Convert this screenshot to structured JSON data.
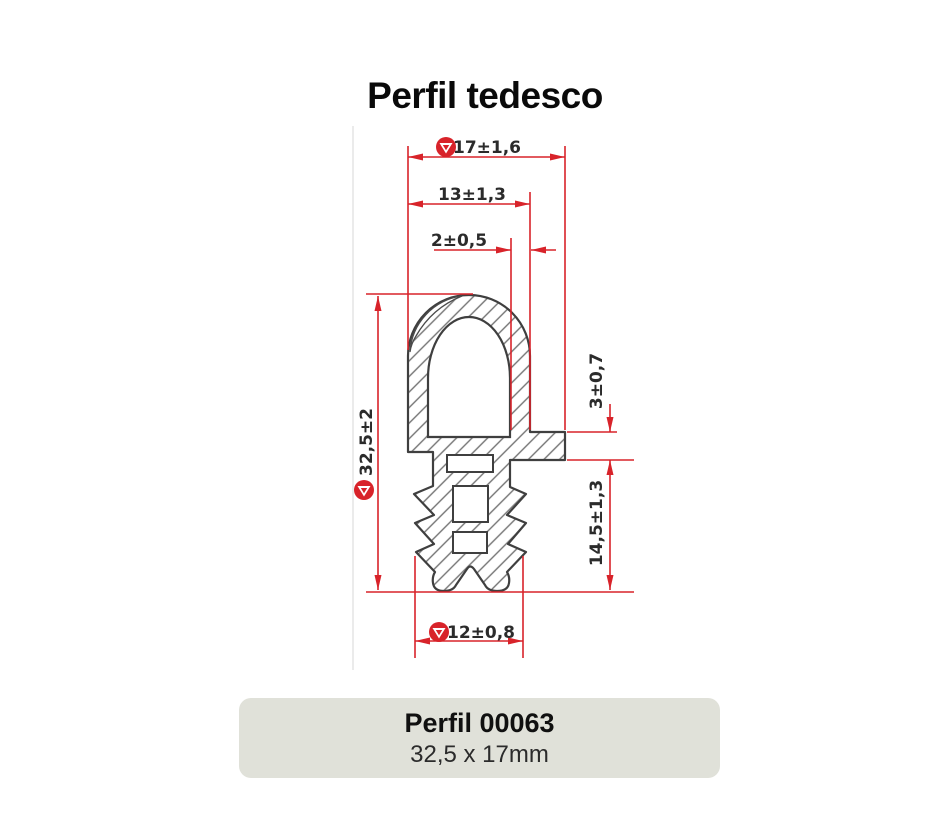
{
  "title": "Perfil tedesco",
  "drawing": {
    "description": "technical cross-section drawing of rubber profile with hatching and red dimension lines",
    "dimensions": {
      "top_width": "17±1,6",
      "head_width": "13±1,3",
      "wall_thickness": "2±0,5",
      "total_height": "32,5±2",
      "flange_thickness": "3±0,7",
      "base_height": "14,5±1,3",
      "base_width": "12±0,8"
    },
    "colors": {
      "dimension_red": "#d8232a",
      "outline": "#3f3f3f",
      "hatch": "#737373"
    }
  },
  "card": {
    "title": "Perfil 00063",
    "subtitle": "32,5 x 17mm",
    "background": "#e0e1d9"
  }
}
